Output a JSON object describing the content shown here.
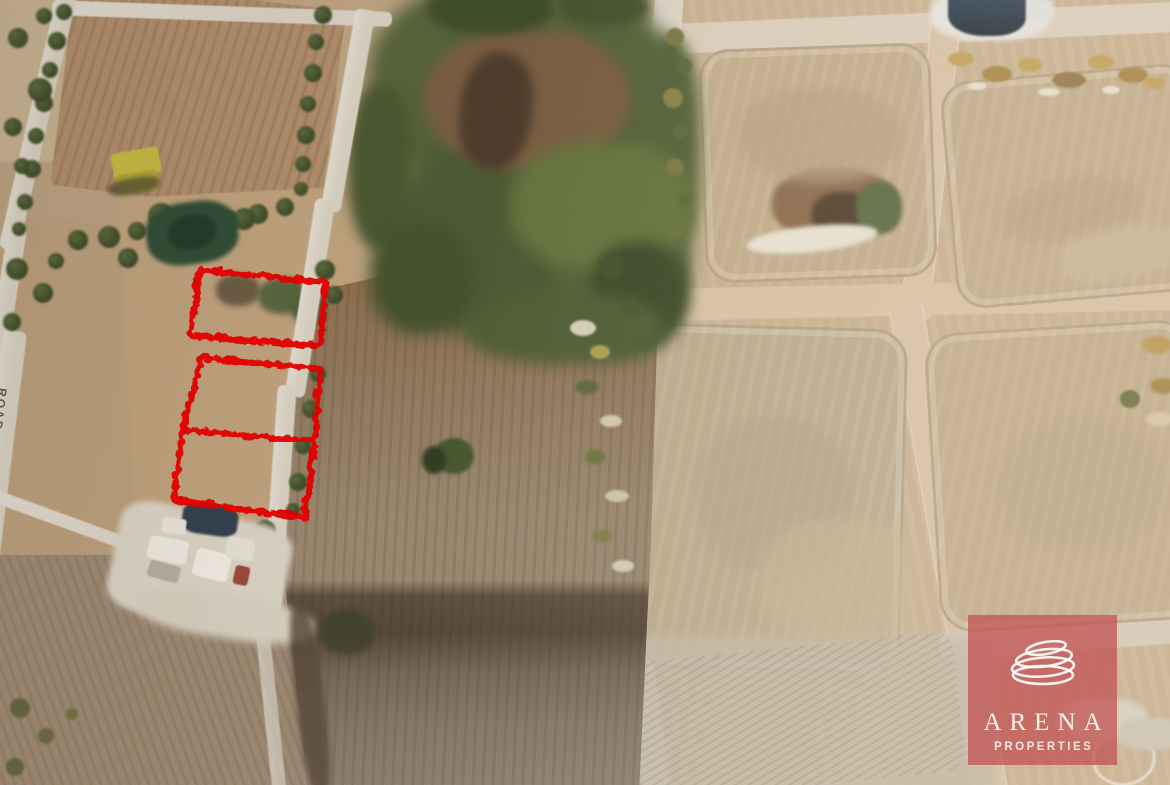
{
  "map": {
    "type": "aerial-satellite-photo",
    "road_label": "ROAD",
    "plot_outline_color": "#e60000",
    "plots": [
      {
        "name": "plot-outline-top",
        "shape": "polygon",
        "points": "198,268 324,281 318,344 189,334"
      },
      {
        "name": "plot-outline-bottom",
        "shape": "polygon",
        "points": "200,356 319,367 313,440 303,516 172,498 181,428"
      },
      {
        "name": "plot-divider-line",
        "shape": "line",
        "points": "181,428 313,440"
      }
    ]
  },
  "watermark": {
    "brand": "ARENA",
    "subtitle": "PROPERTIES",
    "overlay_color": "#c25555"
  }
}
